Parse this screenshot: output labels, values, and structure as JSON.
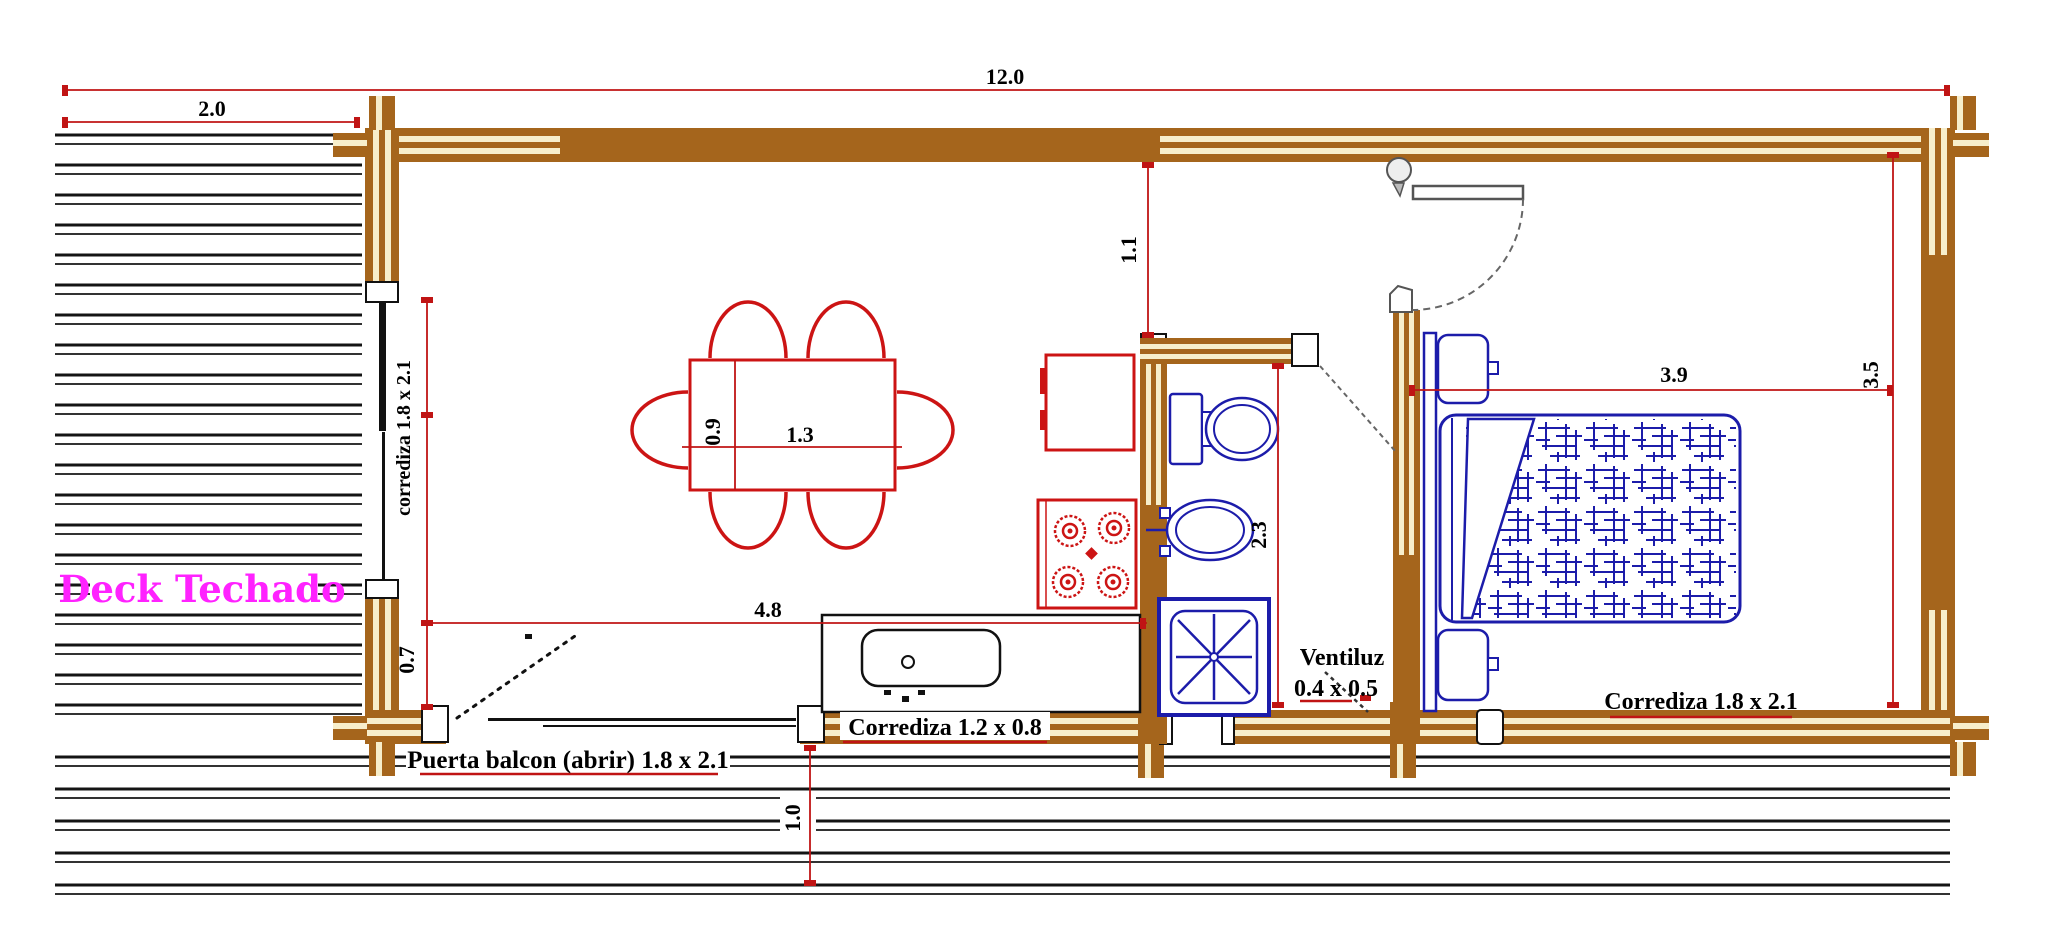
{
  "drawing": {
    "deck_label": "Deck Techado",
    "dimensions": {
      "total_width": "12.0",
      "deck_width": "2.0",
      "table_width": "1.3",
      "table_depth": "0.9",
      "living_width": "4.8",
      "door_offset": "0.7",
      "hall_depth": "1.1",
      "bath_depth": "2.3",
      "bedroom_width": "3.9",
      "bedroom_depth": "3.5",
      "walkway_depth": "1.0"
    },
    "labels": {
      "window_left": "corrediza 1.8 x 2.1",
      "balcony_door": "Puerta balcon (abrir) 1.8 x 2.1",
      "kitchen_window": "Corrediza 1.2 x 0.8",
      "vent_line1": "Ventiluz",
      "vent_line2": "0.4 x 0.5",
      "bedroom_window": "Corrediza 1.8 x 2.1"
    }
  },
  "colors": {
    "dimension": "#c01414",
    "furniture_red": "#cc1414",
    "fixture_blue": "#1c1caa",
    "wall_brown": "#a5651c",
    "wall_cream": "#f7eecb",
    "deck_line": "#141414",
    "label_magenta": "#ff22ff",
    "door_gray": "#666666"
  }
}
